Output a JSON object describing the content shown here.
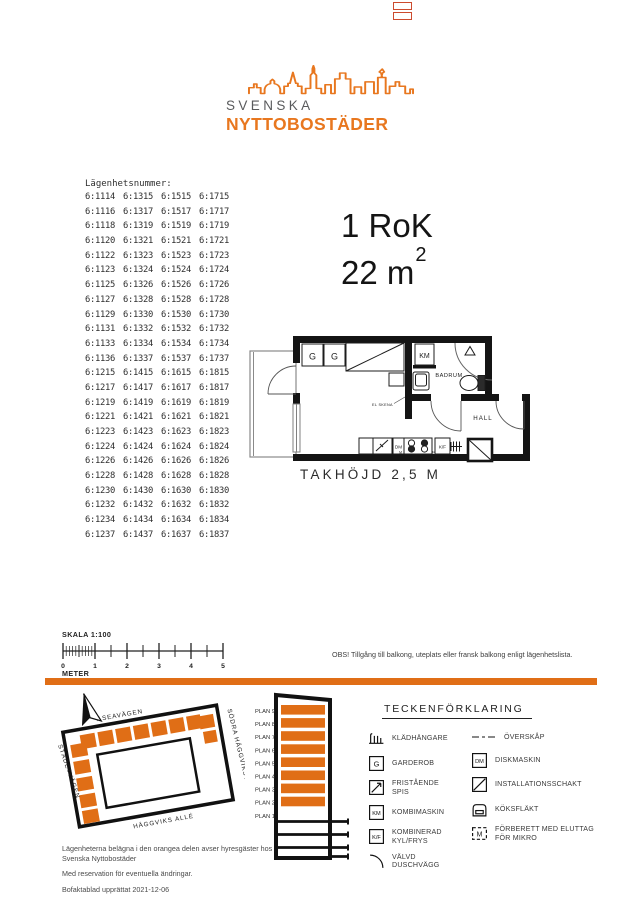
{
  "colors": {
    "accent": "#e06e16",
    "logo_orange": "#e8771f",
    "logo_gray": "#595a5c"
  },
  "logo": {
    "line1": "SVENSKA",
    "line2": "NYTTOBOSTÄDER"
  },
  "apartments": {
    "heading": "Lägenhetsnummer:",
    "rows": [
      [
        "6:1114",
        "6:1315",
        "6:1515",
        "6:1715"
      ],
      [
        "6:1116",
        "6:1317",
        "6:1517",
        "6:1717"
      ],
      [
        "6:1118",
        "6:1319",
        "6:1519",
        "6:1719"
      ],
      [
        "6:1120",
        "6:1321",
        "6:1521",
        "6:1721"
      ],
      [
        "6:1122",
        "6:1323",
        "6:1523",
        "6:1723"
      ],
      [
        "6:1123",
        "6:1324",
        "6:1524",
        "6:1724"
      ],
      [
        "6:1125",
        "6:1326",
        "6:1526",
        "6:1726"
      ],
      [
        "6:1127",
        "6:1328",
        "6:1528",
        "6:1728"
      ],
      [
        "6:1129",
        "6:1330",
        "6:1530",
        "6:1730"
      ],
      [
        "6:1131",
        "6:1332",
        "6:1532",
        "6:1732"
      ],
      [
        "6:1133",
        "6:1334",
        "6:1534",
        "6:1734"
      ],
      [
        "6:1136",
        "6:1337",
        "6:1537",
        "6:1737"
      ],
      [
        "6:1215",
        "6:1415",
        "6:1615",
        "6:1815"
      ],
      [
        "6:1217",
        "6:1417",
        "6:1617",
        "6:1817"
      ],
      [
        "6:1219",
        "6:1419",
        "6:1619",
        "6:1819"
      ],
      [
        "6:1221",
        "6:1421",
        "6:1621",
        "6:1821"
      ],
      [
        "6:1223",
        "6:1423",
        "6:1623",
        "6:1823"
      ],
      [
        "6:1224",
        "6:1424",
        "6:1624",
        "6:1824"
      ],
      [
        "6:1226",
        "6:1426",
        "6:1626",
        "6:1826"
      ],
      [
        "6:1228",
        "6:1428",
        "6:1628",
        "6:1828"
      ],
      [
        "6:1230",
        "6:1430",
        "6:1630",
        "6:1830"
      ],
      [
        "6:1232",
        "6:1432",
        "6:1632",
        "6:1832"
      ],
      [
        "6:1234",
        "6:1434",
        "6:1634",
        "6:1834"
      ],
      [
        "6:1237",
        "6:1437",
        "6:1637",
        "6:1837"
      ]
    ]
  },
  "unit": {
    "type": "1 RoK",
    "area": "22 m",
    "area_sup": "2"
  },
  "floorplan": {
    "labels": {
      "g1": "G",
      "g2": "G",
      "km": "KM",
      "badrum": "BADRUM",
      "hall": "HALL",
      "dm": "DM",
      "kf": "K/F",
      "m1": "M",
      "m2": "M",
      "el_note": "EL SKENA"
    },
    "ceiling_height": "TAKHÖJD 2,5 M"
  },
  "scalebar": {
    "title": "SKALA 1:100",
    "tick_labels": [
      "0",
      "1",
      "2",
      "3",
      "4",
      "5"
    ],
    "unit": "METER"
  },
  "note": {
    "text": "OBS! Tillgång till balkong, uteplats eller fransk balkong enligt lägenhetslista."
  },
  "sitemap": {
    "streets": {
      "top": "ASEAVÄGEN",
      "right": "SÖDRA HÄGGVIKSVÄGEN",
      "left": "STÄDETVÄGEN",
      "bottom": "HÄGGVIKS ALLÉ"
    }
  },
  "stack": {
    "floors": [
      {
        "label": "PLAN 9",
        "orange": true
      },
      {
        "label": "PLAN 8",
        "orange": true
      },
      {
        "label": "PLAN 7",
        "orange": true
      },
      {
        "label": "PLAN 6",
        "orange": true
      },
      {
        "label": "PLAN 5",
        "orange": true
      },
      {
        "label": "PLAN 4",
        "orange": true
      },
      {
        "label": "PLAN 3",
        "orange": true
      },
      {
        "label": "PLAN 2",
        "orange": true
      },
      {
        "label": "PLAN 1",
        "orange": false
      }
    ]
  },
  "legend": {
    "title": "TECKENFÖRKLARING",
    "left": [
      {
        "icon": "coat-hanger-icon",
        "symbol": "hanger",
        "label": "KLÄDHÄNGARE"
      },
      {
        "icon": "garderob-icon",
        "symbol": "box",
        "letter": "G",
        "label": "GARDEROB"
      },
      {
        "icon": "fristaende-spis-icon",
        "symbol": "spis",
        "label": "FRISTÅENDE SPIS"
      },
      {
        "icon": "kombimaskin-icon",
        "symbol": "box",
        "letter": "KM",
        "label": "KOMBIMASKIN"
      },
      {
        "icon": "kyl-frys-icon",
        "symbol": "box",
        "letter": "K/F",
        "label": "KOMBINERAD KYL/FRYS"
      },
      {
        "icon": "valvd-duschvagg-icon",
        "symbol": "arc",
        "label": "VÄLVD DUSCHVÄGG"
      }
    ],
    "right": [
      {
        "icon": "overskap-icon",
        "symbol": "dash",
        "label": "ÖVERSKÅP"
      },
      {
        "icon": "diskmaskin-icon",
        "symbol": "box",
        "letter": "DM",
        "label": "DISKMASKIN"
      },
      {
        "icon": "installationsschakt-icon",
        "symbol": "diag",
        "label": "INSTALLATIONSSCHAKT"
      },
      {
        "icon": "koksflakt-icon",
        "symbol": "hood",
        "label": "KÖKSFLÄKT"
      },
      {
        "icon": "mikro-icon",
        "symbol": "micro",
        "letter": "M",
        "label": "FÖRBERETT MED ELUTTAG FÖR MIKRO"
      }
    ]
  },
  "footer": {
    "line1": "Lägenheterna belägna i den orangea delen avser hyresgäster hos Svenska Nyttobostäder",
    "line2": "Med reservation för eventuella ändringar.",
    "line3": "Bofaktablad upprättat 2021-12-06"
  }
}
